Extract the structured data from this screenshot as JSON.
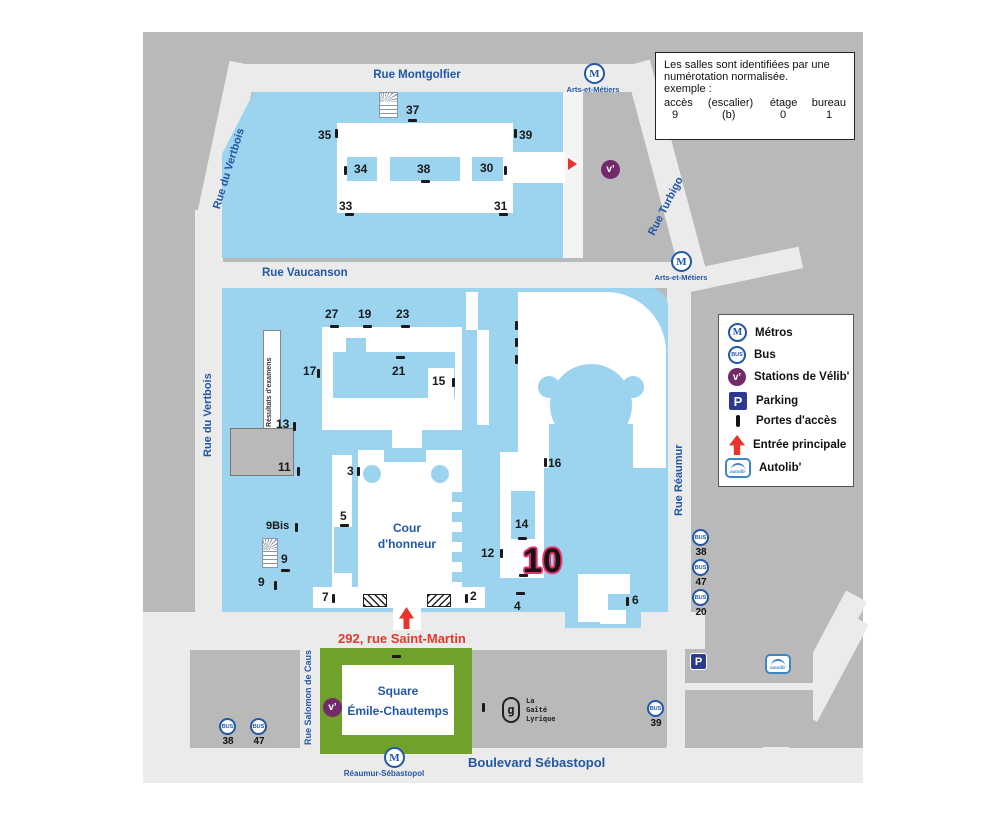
{
  "info_box": {
    "line1": "Les salles sont identifiées par une",
    "line2": "numérotation normalisée.",
    "line3": "exemple :",
    "columns": [
      "accès",
      "(escalier)",
      "étage",
      "bureau"
    ],
    "values": [
      "9",
      "(b)",
      "0",
      "1"
    ]
  },
  "legend": {
    "metros": "Métros",
    "bus": "Bus",
    "velib": "Stations de Vélib'",
    "parking": "Parking",
    "portes": "Portes d'accès",
    "entree": "Entrée principale",
    "autolib": "Autolib'"
  },
  "streets": {
    "montgolfier": "Rue Montgolfier",
    "vertbois_diag": "Rue du Vertbois",
    "vertbois_left": "Rue du Vertbois",
    "vaucanson": "Rue Vaucanson",
    "turbigo": "Rue Turbigo",
    "reaumur": "Rue Réaumur",
    "salomon": "Rue Salomon de Caus",
    "sebastopol": "Boulevard Sébastopol"
  },
  "metro_stations": {
    "arts1": "Arts-et-Métiers",
    "arts2": "Arts-et-Métiers",
    "reaumur_sebastopol": "Réaumur-Sébastopol"
  },
  "places": {
    "address": "292, rue Saint-Martin",
    "cour_line1": "Cour",
    "cour_line2": "d'honneur",
    "resultats": "Résultats d'examens",
    "square_line1": "Square",
    "square_line2": "Émile-Chautemps",
    "gaite_line1": "La",
    "gaite_line2": "Gaîté",
    "gaite_line3": "Lyrique",
    "gaite_glyph": "g"
  },
  "numbers": {
    "n37": "37",
    "n35": "35",
    "n39": "39",
    "n34": "34",
    "n38": "38",
    "n30": "30",
    "n33": "33",
    "n31": "31",
    "n27": "27",
    "n19": "19",
    "n23": "23",
    "n17": "17",
    "n21": "21",
    "n15": "15",
    "n13": "13",
    "n11": "11",
    "n3": "3",
    "n5": "5",
    "n9bis": "9Bis",
    "n9a": "9",
    "n9b": "9",
    "n7": "7",
    "n2": "2",
    "n4": "4",
    "n12": "12",
    "n14": "14",
    "n16": "16",
    "n6": "6",
    "n10": "10"
  },
  "bus_stops": {
    "reaumur": [
      "38",
      "47",
      "20"
    ],
    "saint_martin": [
      "38",
      "47"
    ],
    "sebastopol": "39"
  },
  "icons": {
    "metro_letter": "M",
    "bus_text": "BUS",
    "velib_text": "v’",
    "parking_letter": "P",
    "autolib_text": "autolib’"
  },
  "colors": {
    "campus_blue": "#9cd3ef",
    "map_gray": "#b9b9b9",
    "street_gray": "#ebebeb",
    "square_green": "#70a12d",
    "brand_blue": "#2257a5",
    "entrance_red": "#e8352c",
    "highlight_pink": "#ea2e68",
    "velib_purple": "#722a6b",
    "parking_blue": "#2b3a8f"
  }
}
